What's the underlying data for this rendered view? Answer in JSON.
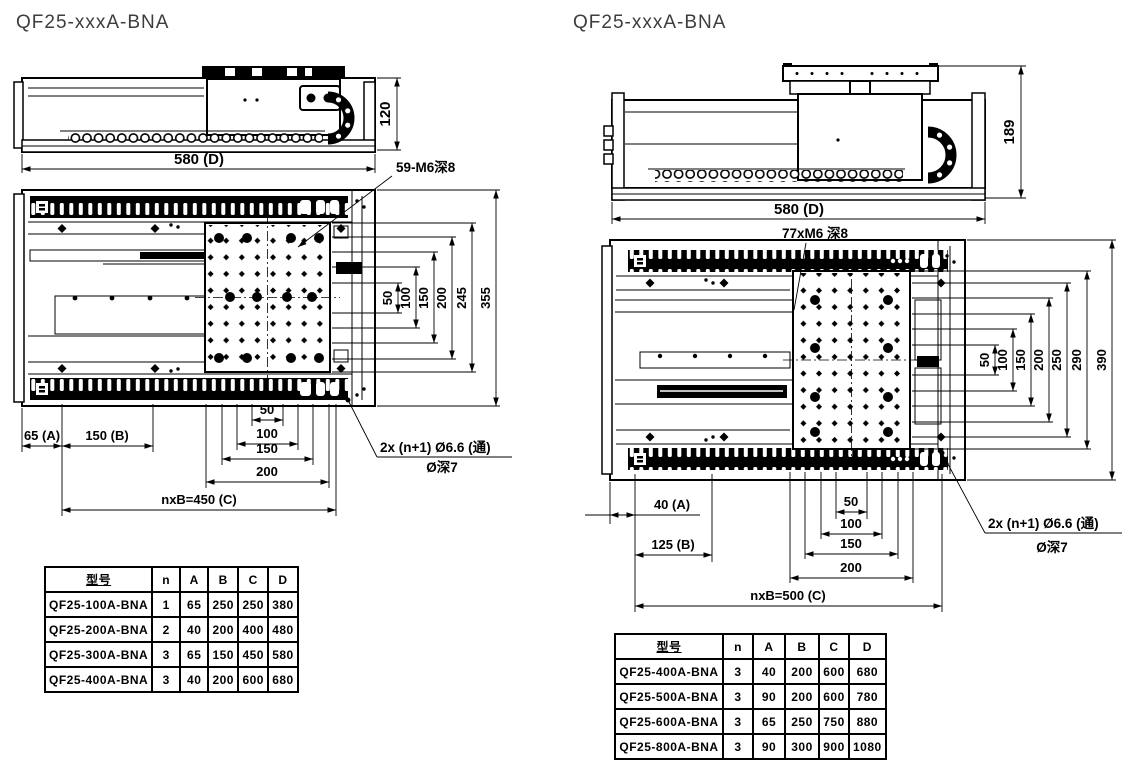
{
  "colors": {
    "ink": "#000000",
    "background": "#ffffff",
    "title_text": "#3d3d3d"
  },
  "left": {
    "title": "QF25-xxxA-BNA",
    "side_view": {
      "length_dim": "580 (D)",
      "height_dim": "120"
    },
    "top_view": {
      "thread_callout": "59-M6深8",
      "vertical_dims": [
        "50",
        "100",
        "150",
        "200",
        "245",
        "355"
      ],
      "offset_a": "65 (A)",
      "pitch_b": "150 (B)",
      "center_dims": [
        "50",
        "100",
        "150",
        "200"
      ],
      "total_length": "nxB=450 (C)",
      "base_hole_callout_1": "2x (n+1) Ø6.6 (通)",
      "base_hole_callout_2": "Ø深7"
    },
    "table": {
      "headers": [
        "型号",
        "n",
        "A",
        "B",
        "C",
        "D"
      ],
      "rows": [
        [
          "QF25-100A-BNA",
          "1",
          "65",
          "250",
          "250",
          "380"
        ],
        [
          "QF25-200A-BNA",
          "2",
          "40",
          "200",
          "400",
          "480"
        ],
        [
          "QF25-300A-BNA",
          "3",
          "65",
          "150",
          "450",
          "580"
        ],
        [
          "QF25-400A-BNA",
          "3",
          "40",
          "200",
          "600",
          "680"
        ]
      ]
    }
  },
  "right": {
    "title": "QF25-xxxA-BNA",
    "side_view": {
      "length_dim": "580 (D)",
      "height_dim": "189"
    },
    "top_view": {
      "thread_callout": "77xM6 深8",
      "vertical_dims": [
        "50",
        "100",
        "150",
        "200",
        "250",
        "290",
        "390"
      ],
      "offset_a": "40 (A)",
      "pitch_b": "125 (B)",
      "center_dims": [
        "50",
        "100",
        "150",
        "200"
      ],
      "total_length": "nxB=500 (C)",
      "base_hole_callout_1": "2x (n+1) Ø6.6 (通)",
      "base_hole_callout_2": "Ø深7"
    },
    "table": {
      "headers": [
        "型号",
        "n",
        "A",
        "B",
        "C",
        "D"
      ],
      "rows": [
        [
          "QF25-400A-BNA",
          "3",
          "40",
          "200",
          "600",
          "680"
        ],
        [
          "QF25-500A-BNA",
          "3",
          "90",
          "200",
          "600",
          "780"
        ],
        [
          "QF25-600A-BNA",
          "3",
          "65",
          "250",
          "750",
          "880"
        ],
        [
          "QF25-800A-BNA",
          "3",
          "90",
          "300",
          "900",
          "1080"
        ]
      ]
    }
  }
}
